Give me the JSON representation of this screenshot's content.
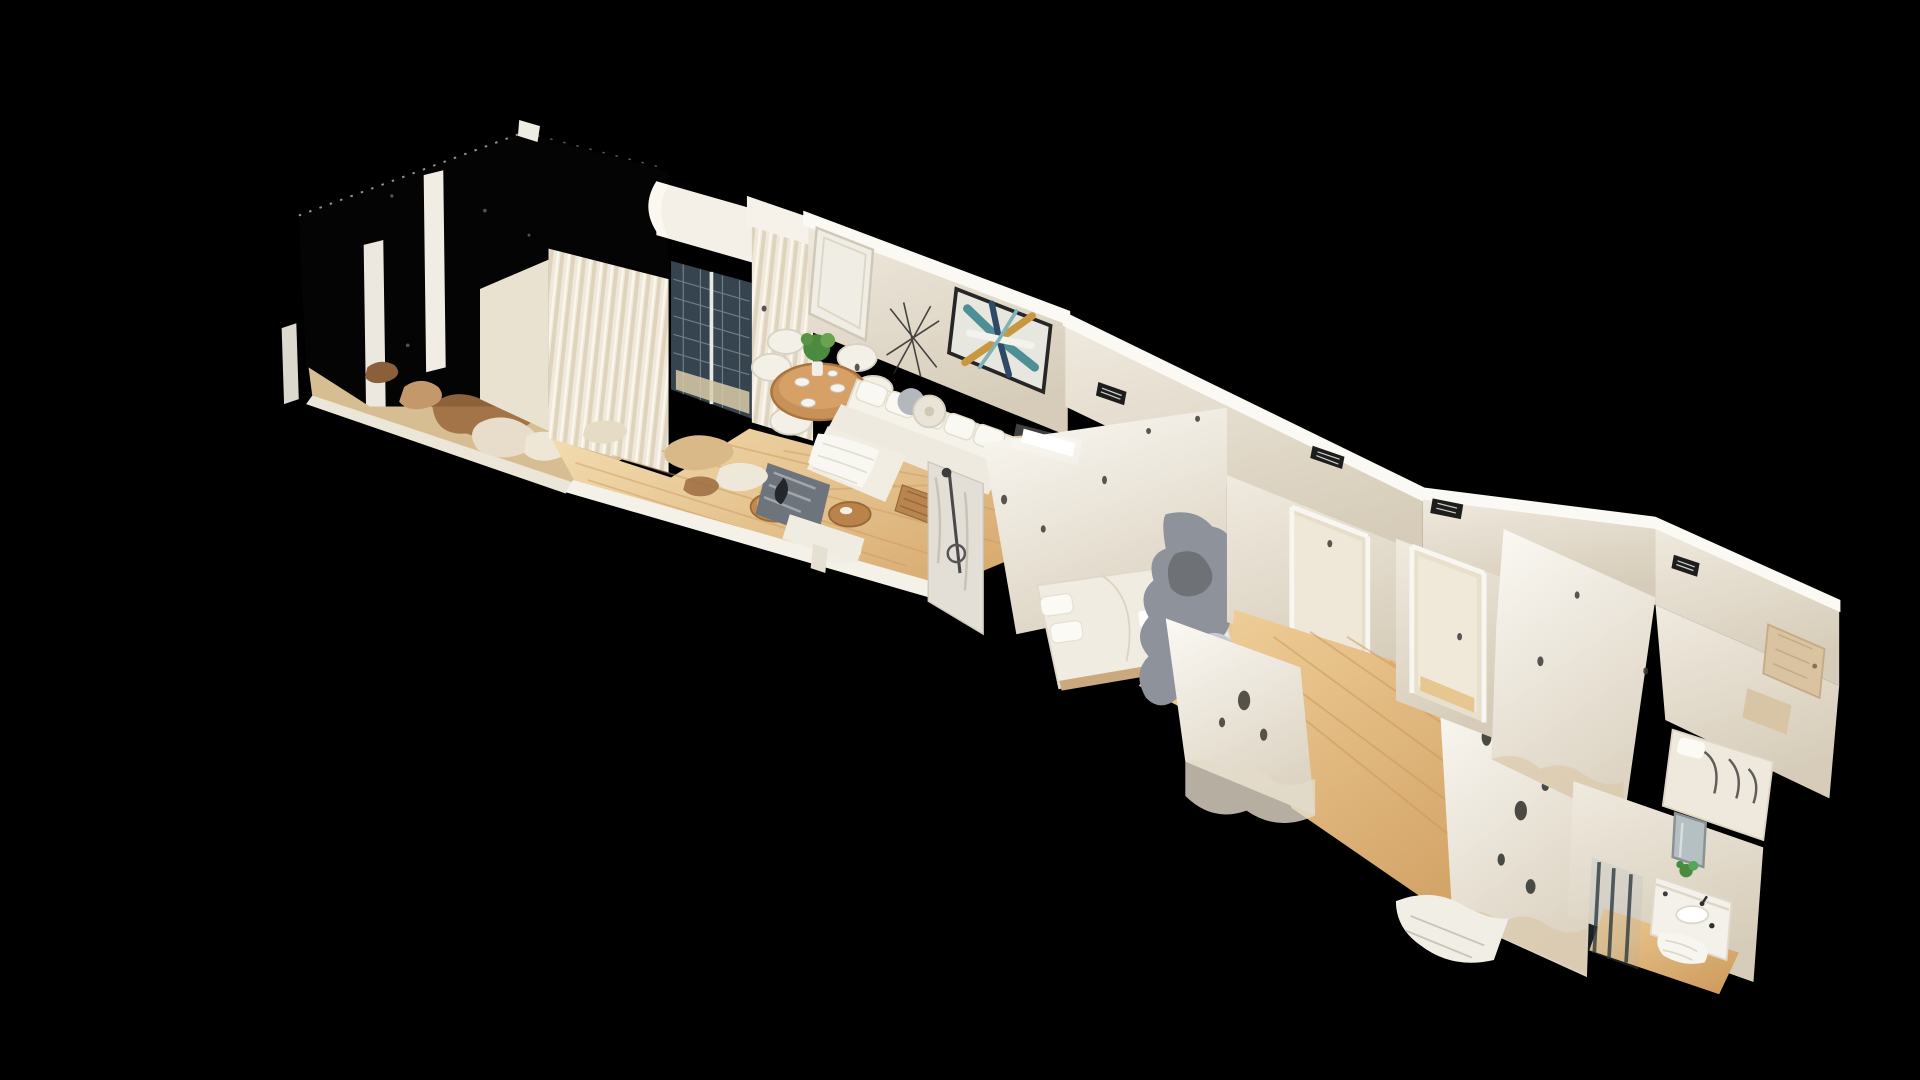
{
  "scene": {
    "type": "3d-dollhouse-cutaway",
    "subject": "single-floor apartment 3D scan viewed from above on a black background",
    "rooms": [
      {
        "name": "balcony"
      },
      {
        "name": "living-room"
      },
      {
        "name": "dining-area"
      },
      {
        "name": "bedroom-1"
      },
      {
        "name": "bedroom-2"
      },
      {
        "name": "hallway"
      },
      {
        "name": "bedroom-3"
      },
      {
        "name": "bathroom"
      }
    ],
    "colors": {
      "background": "#000000",
      "floor_light": "#f3ddb0",
      "floor_dark": "#d8ab70",
      "hall_floor_light": "#eecd96",
      "hall_floor_dark": "#cf9d60",
      "wall_bright": "#fbf9f4",
      "wall_mid": "#f0eadf",
      "wall_shade": "#ddd4c3",
      "curtain": "#f0e9db",
      "window_blind": "#35444e",
      "wood_furniture": "#c8915a",
      "artifact_gray": "#8e939b",
      "artifact_gray_dark": "#6e7277",
      "plant_green": "#4c8b3f",
      "art_teal": "#4e8f96",
      "art_gold": "#c9973f",
      "art_navy": "#2e4a66",
      "vent_dark": "#1d1d1d",
      "marble": "#e3dfd6",
      "mirror_glass": "#b5c0c2",
      "debris_brown": "#9c6b3f",
      "debris_tan": "#d6bd92"
    }
  }
}
